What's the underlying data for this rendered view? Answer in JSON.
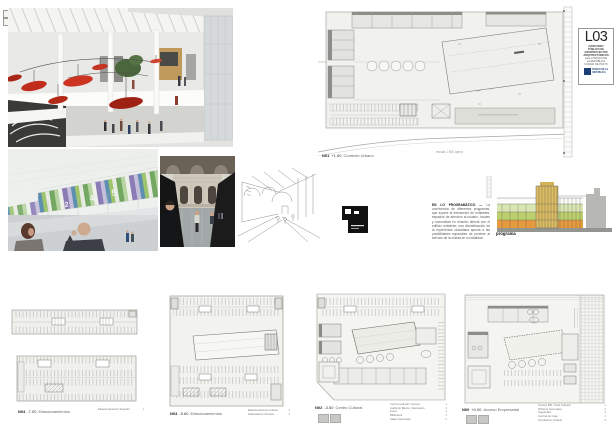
{
  "page": {
    "title_block": {
      "code": "L03",
      "lines": [
        "CONCURSO",
        "PÚBLICO DE",
        "ANTEPROYECTOS",
        "ARQUITECTÓNICOS",
        "para el BANCO DE",
        "LA REPÚBLICA",
        "CIUDAD DE PASTO"
      ],
      "logo_line1": "BANCO DE LA",
      "logo_line2": "REPÚBLICA"
    },
    "main_plan": {
      "code": "N01",
      "level": "+1.50",
      "name": "Contexto Urbano",
      "scale_note": "escala 1:500 aprox"
    },
    "concept": {
      "heading": "EN LO PROGRAMÁTICO — ",
      "body": "La convivencia de diferentes programas, que supere la interacción de entidades; espacios de atención al usuario, locales y comunidad en relación directa con el edificio existente; esa diversificación de la experiencia ciudadana apunta a las posibilidades espaciales de ponerse al servicio de la ciudad en su totalidad."
    },
    "program_diagram": {
      "caption": "programa"
    },
    "render_hall": {
      "numbers": [
        "2",
        "4",
        "5"
      ]
    },
    "plans": [
      {
        "code": "N04",
        "level": "-7.00",
        "name": "Estacionamientos",
        "legend": [
          {
            "t": "Estacionamiento Superior",
            "n": "1"
          }
        ]
      },
      {
        "code": "N03",
        "level": "-5.60",
        "name": "Estacionamientos",
        "legend": [
          {
            "t": "Estacionamiento Inferior",
            "n": "1"
          },
          {
            "t": "Subestación Técnica",
            "n": "2"
          }
        ]
      },
      {
        "code": "N02",
        "level": "-3.50",
        "name": "Centro Cultural",
        "legend": [
          {
            "t": "Centro Cultural / Acceso",
            "n": "1"
          },
          {
            "t": "Auditorio Banco / Escenario",
            "n": "2"
          },
          {
            "t": "Foyer",
            "n": "3"
          },
          {
            "t": "Biblioteca",
            "n": "4"
          },
          {
            "t": "Salas Generales",
            "n": "5"
          }
        ]
      },
      {
        "code": "N00",
        "level": "+0.00",
        "name": "Acceso Empresarial",
        "legend": [
          {
            "t": "Acceso BR / Café Cultural",
            "n": "1"
          },
          {
            "t": "Oficinas Generales",
            "n": "2"
          },
          {
            "t": "Seguridad",
            "n": "3"
          },
          {
            "t": "Central de Caja",
            "n": "4"
          },
          {
            "t": "Circulación Vertical",
            "n": "5"
          }
        ]
      }
    ]
  }
}
